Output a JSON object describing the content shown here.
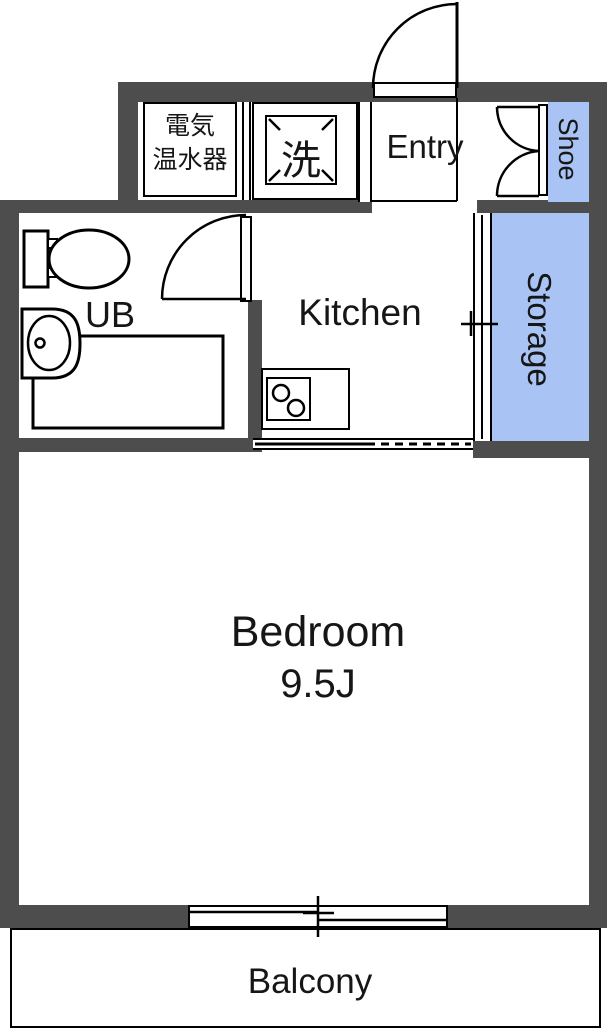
{
  "rooms": {
    "entry": {
      "label": "Entry"
    },
    "kitchen": {
      "label": "Kitchen"
    },
    "bedroom": {
      "label": "Bedroom",
      "size": "9.5J"
    },
    "balcony": {
      "label": "Balcony"
    },
    "unit_bath": {
      "label": "UB"
    },
    "storage": {
      "label": "Storage"
    },
    "shoe_cabinet": {
      "label": "Shoe"
    },
    "water_heater": {
      "line1": "電気",
      "line2": "温水器"
    },
    "washing_machine": {
      "label": "洗"
    }
  },
  "colors": {
    "wall": "#4d4d4d",
    "cabinet_fill": "#a9c4f4",
    "line": "#000000",
    "floor": "#ffffff"
  },
  "fixtures": [
    "toilet",
    "sink",
    "bathtub",
    "stove-2-burner",
    "entry-door",
    "ub-door",
    "shoe-double-door",
    "storage-sliding-door",
    "bedroom-sliding-window"
  ]
}
